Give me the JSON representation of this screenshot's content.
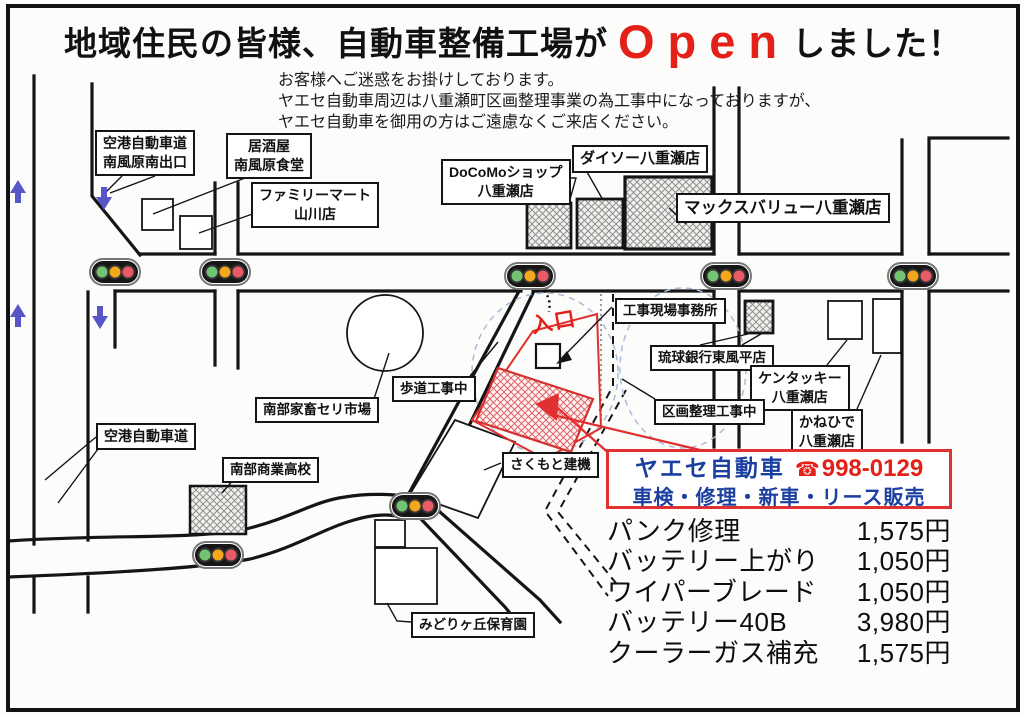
{
  "title": {
    "pre": "地域住民の皆様、自動車整備工場が",
    "open": "Open",
    "post": "しました！"
  },
  "notice": [
    "お客様へご迷惑をお掛けしております。",
    "ヤエセ自動車周辺は八重瀬町区画整理事業の為工事中になっておりますが、",
    "ヤエセ自動車を御用の方はご遠慮なくご来店ください。"
  ],
  "map": {
    "entrance": "入口",
    "labels": [
      {
        "id": "airport-exit",
        "text": "空港自動車道\n南風原南出口"
      },
      {
        "id": "izakaya",
        "text": "居酒屋\n南風原食堂"
      },
      {
        "id": "familymart",
        "text": "ファミリーマート\n山川店"
      },
      {
        "id": "docomo",
        "text": "DoCoMoショップ\n八重瀬店"
      },
      {
        "id": "daiso",
        "text": "ダイソー八重瀬店"
      },
      {
        "id": "maxvalu",
        "text": "マックスバリュー八重瀬店"
      },
      {
        "id": "site-office",
        "text": "工事現場事務所"
      },
      {
        "id": "ryukyu-bank",
        "text": "琉球銀行東風平店"
      },
      {
        "id": "kentucky",
        "text": "ケンタッキー\n八重瀬店"
      },
      {
        "id": "kanehide",
        "text": "かねひで\n八重瀬店"
      },
      {
        "id": "kukaku-koji",
        "text": "区画整理工事中"
      },
      {
        "id": "hodo-koji",
        "text": "歩道工事中"
      },
      {
        "id": "cattle-market",
        "text": "南部家畜セリ市場"
      },
      {
        "id": "airport-road",
        "text": "空港自動車道"
      },
      {
        "id": "nanbu-high",
        "text": "南部商業高校"
      },
      {
        "id": "sakumoto",
        "text": "さくもと建機"
      },
      {
        "id": "midorigaoka",
        "text": "みどりヶ丘保育園"
      }
    ]
  },
  "shop": {
    "name": "ヤエセ自動車",
    "phone_icon": "☎",
    "phone": "998-0129",
    "services": "車検・修理・新車・リース販売"
  },
  "prices": [
    {
      "item": "パンク修理",
      "price": "1,575円"
    },
    {
      "item": "バッテリー上がり",
      "price": "1,050円"
    },
    {
      "item": "ワイパーブレード",
      "price": "1,050円"
    },
    {
      "item": "バッテリー40B",
      "price": "3,980円"
    },
    {
      "item": "クーラーガス補充",
      "price": "1,575円"
    }
  ],
  "colors": {
    "accent_red": "#e32119",
    "brand_blue": "#1b3fa0",
    "arrow_blue": "#5656c8",
    "signal_green": "#72c472",
    "signal_yellow": "#f2a71c",
    "signal_red": "#ea5a66"
  }
}
